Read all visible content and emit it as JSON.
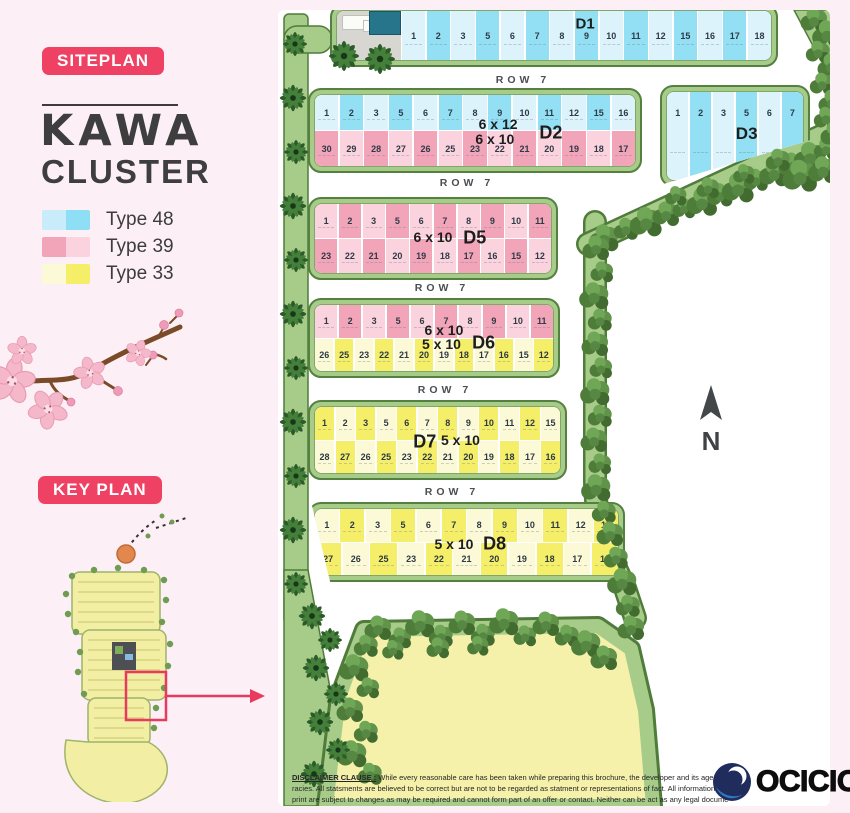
{
  "theme": {
    "accent_pink": "#ef4164",
    "band_green": "#a7cb89",
    "band_green_dark": "#54813f",
    "background_pink": "#fcf0f6",
    "open_area_yellow": "#f5f1ab"
  },
  "sidebar": {
    "siteplan_badge": "SITEPLAN",
    "title": "KAWA",
    "subtitle": "CLUSTER",
    "legend": [
      {
        "label": "Type 48",
        "left": "#c8ecfa",
        "right": "#8edef5"
      },
      {
        "label": "Type 39",
        "left": "#f2a4b9",
        "right": "#fbd3de"
      },
      {
        "label": "Type 33",
        "left": "#fbf9d6",
        "right": "#f4ee68"
      }
    ],
    "keyplan_badge": "KEY PLAN"
  },
  "siteplan": {
    "row_street_label": "ROW 7",
    "north": "N",
    "colors": {
      "blue": {
        "light": "#dcf3fb",
        "dark": "#93dff4"
      },
      "pink": {
        "light": "#fbd3de",
        "dark": "#f2a4b9"
      },
      "yellow": {
        "light": "#fbf9d6",
        "dark": "#f4ee68"
      }
    },
    "blocks": {
      "d1": {
        "label": "D1",
        "row_top": {
          "scheme": "blue",
          "start": "light",
          "lots": [
            "1",
            "2",
            "3",
            "5",
            "6",
            "7",
            "8",
            "9",
            "10",
            "11",
            "12",
            "15",
            "16",
            "17",
            "18"
          ]
        }
      },
      "d2": {
        "label": "D2",
        "size_top": "6 x 12",
        "size_bottom": "6 x 10",
        "row_top": {
          "scheme": "blue",
          "start": "light",
          "lots": [
            "1",
            "2",
            "3",
            "5",
            "6",
            "7",
            "8",
            "9",
            "10",
            "11",
            "12",
            "15",
            "16"
          ]
        },
        "row_bottom": {
          "scheme": "pink",
          "start": "dark",
          "lots": [
            "30",
            "29",
            "28",
            "27",
            "26",
            "25",
            "23",
            "22",
            "21",
            "20",
            "19",
            "18",
            "17"
          ]
        }
      },
      "d3": {
        "label": "D3",
        "row_top": {
          "scheme": "blue",
          "start": "light",
          "lots": [
            "1",
            "2",
            "3",
            "5",
            "6",
            "7"
          ]
        }
      },
      "d5": {
        "label": "D5",
        "size_top": "6 x 10",
        "row_top": {
          "scheme": "pink",
          "start": "light",
          "lots": [
            "1",
            "2",
            "3",
            "5",
            "6",
            "7",
            "8",
            "9",
            "10",
            "11"
          ]
        },
        "row_bottom": {
          "scheme": "pink",
          "start": "dark",
          "lots": [
            "23",
            "22",
            "21",
            "20",
            "19",
            "18",
            "17",
            "16",
            "15",
            "12"
          ]
        }
      },
      "d6": {
        "label": "D6",
        "size_top": "6 x 10",
        "size_bottom": "5 x 10",
        "row_top": {
          "scheme": "pink",
          "start": "light",
          "lots": [
            "1",
            "2",
            "3",
            "5",
            "6",
            "7",
            "8",
            "9",
            "10",
            "11"
          ]
        },
        "row_bottom": {
          "scheme": "yellow",
          "start": "light",
          "lots": [
            "26",
            "25",
            "23",
            "22",
            "21",
            "20",
            "19",
            "18",
            "17",
            "16",
            "15",
            "12"
          ]
        }
      },
      "d7": {
        "label": "D7",
        "size_top": "5 x 10",
        "row_top": {
          "scheme": "yellow",
          "start": "dark",
          "lots": [
            "1",
            "2",
            "3",
            "5",
            "6",
            "7",
            "8",
            "9",
            "10",
            "11",
            "12",
            "15"
          ]
        },
        "row_bottom": {
          "scheme": "yellow",
          "start": "light",
          "lots": [
            "28",
            "27",
            "26",
            "25",
            "23",
            "22",
            "21",
            "20",
            "19",
            "18",
            "17",
            "16"
          ]
        }
      },
      "d8": {
        "label": "D8",
        "size_top": "5 x 10",
        "row_top": {
          "scheme": "yellow",
          "start": "light",
          "lots": [
            "1",
            "2",
            "3",
            "5",
            "6",
            "7",
            "8",
            "9",
            "10",
            "11",
            "12",
            "15"
          ]
        },
        "row_bottom": {
          "scheme": "yellow",
          "start": "dark",
          "lots": [
            "27",
            "26",
            "25",
            "23",
            "22",
            "21",
            "20",
            "19",
            "18",
            "17",
            "16"
          ]
        }
      }
    }
  },
  "footer": {
    "disclaimer_title": "DISCLAIMER CLAUSE :",
    "line1": "While every reasonable care has been taken while preparing this brochure, the developer and its agent cannot be",
    "line2": "racies. All statsments are believed to be correct but are not to be regarded as statment or representations of fact. All information and sp",
    "line3": "print are subject to changes as may be required and cannot form part of an offer or contact. Neither can be act as any legal documents.",
    "logo_text": "OCICIO"
  }
}
